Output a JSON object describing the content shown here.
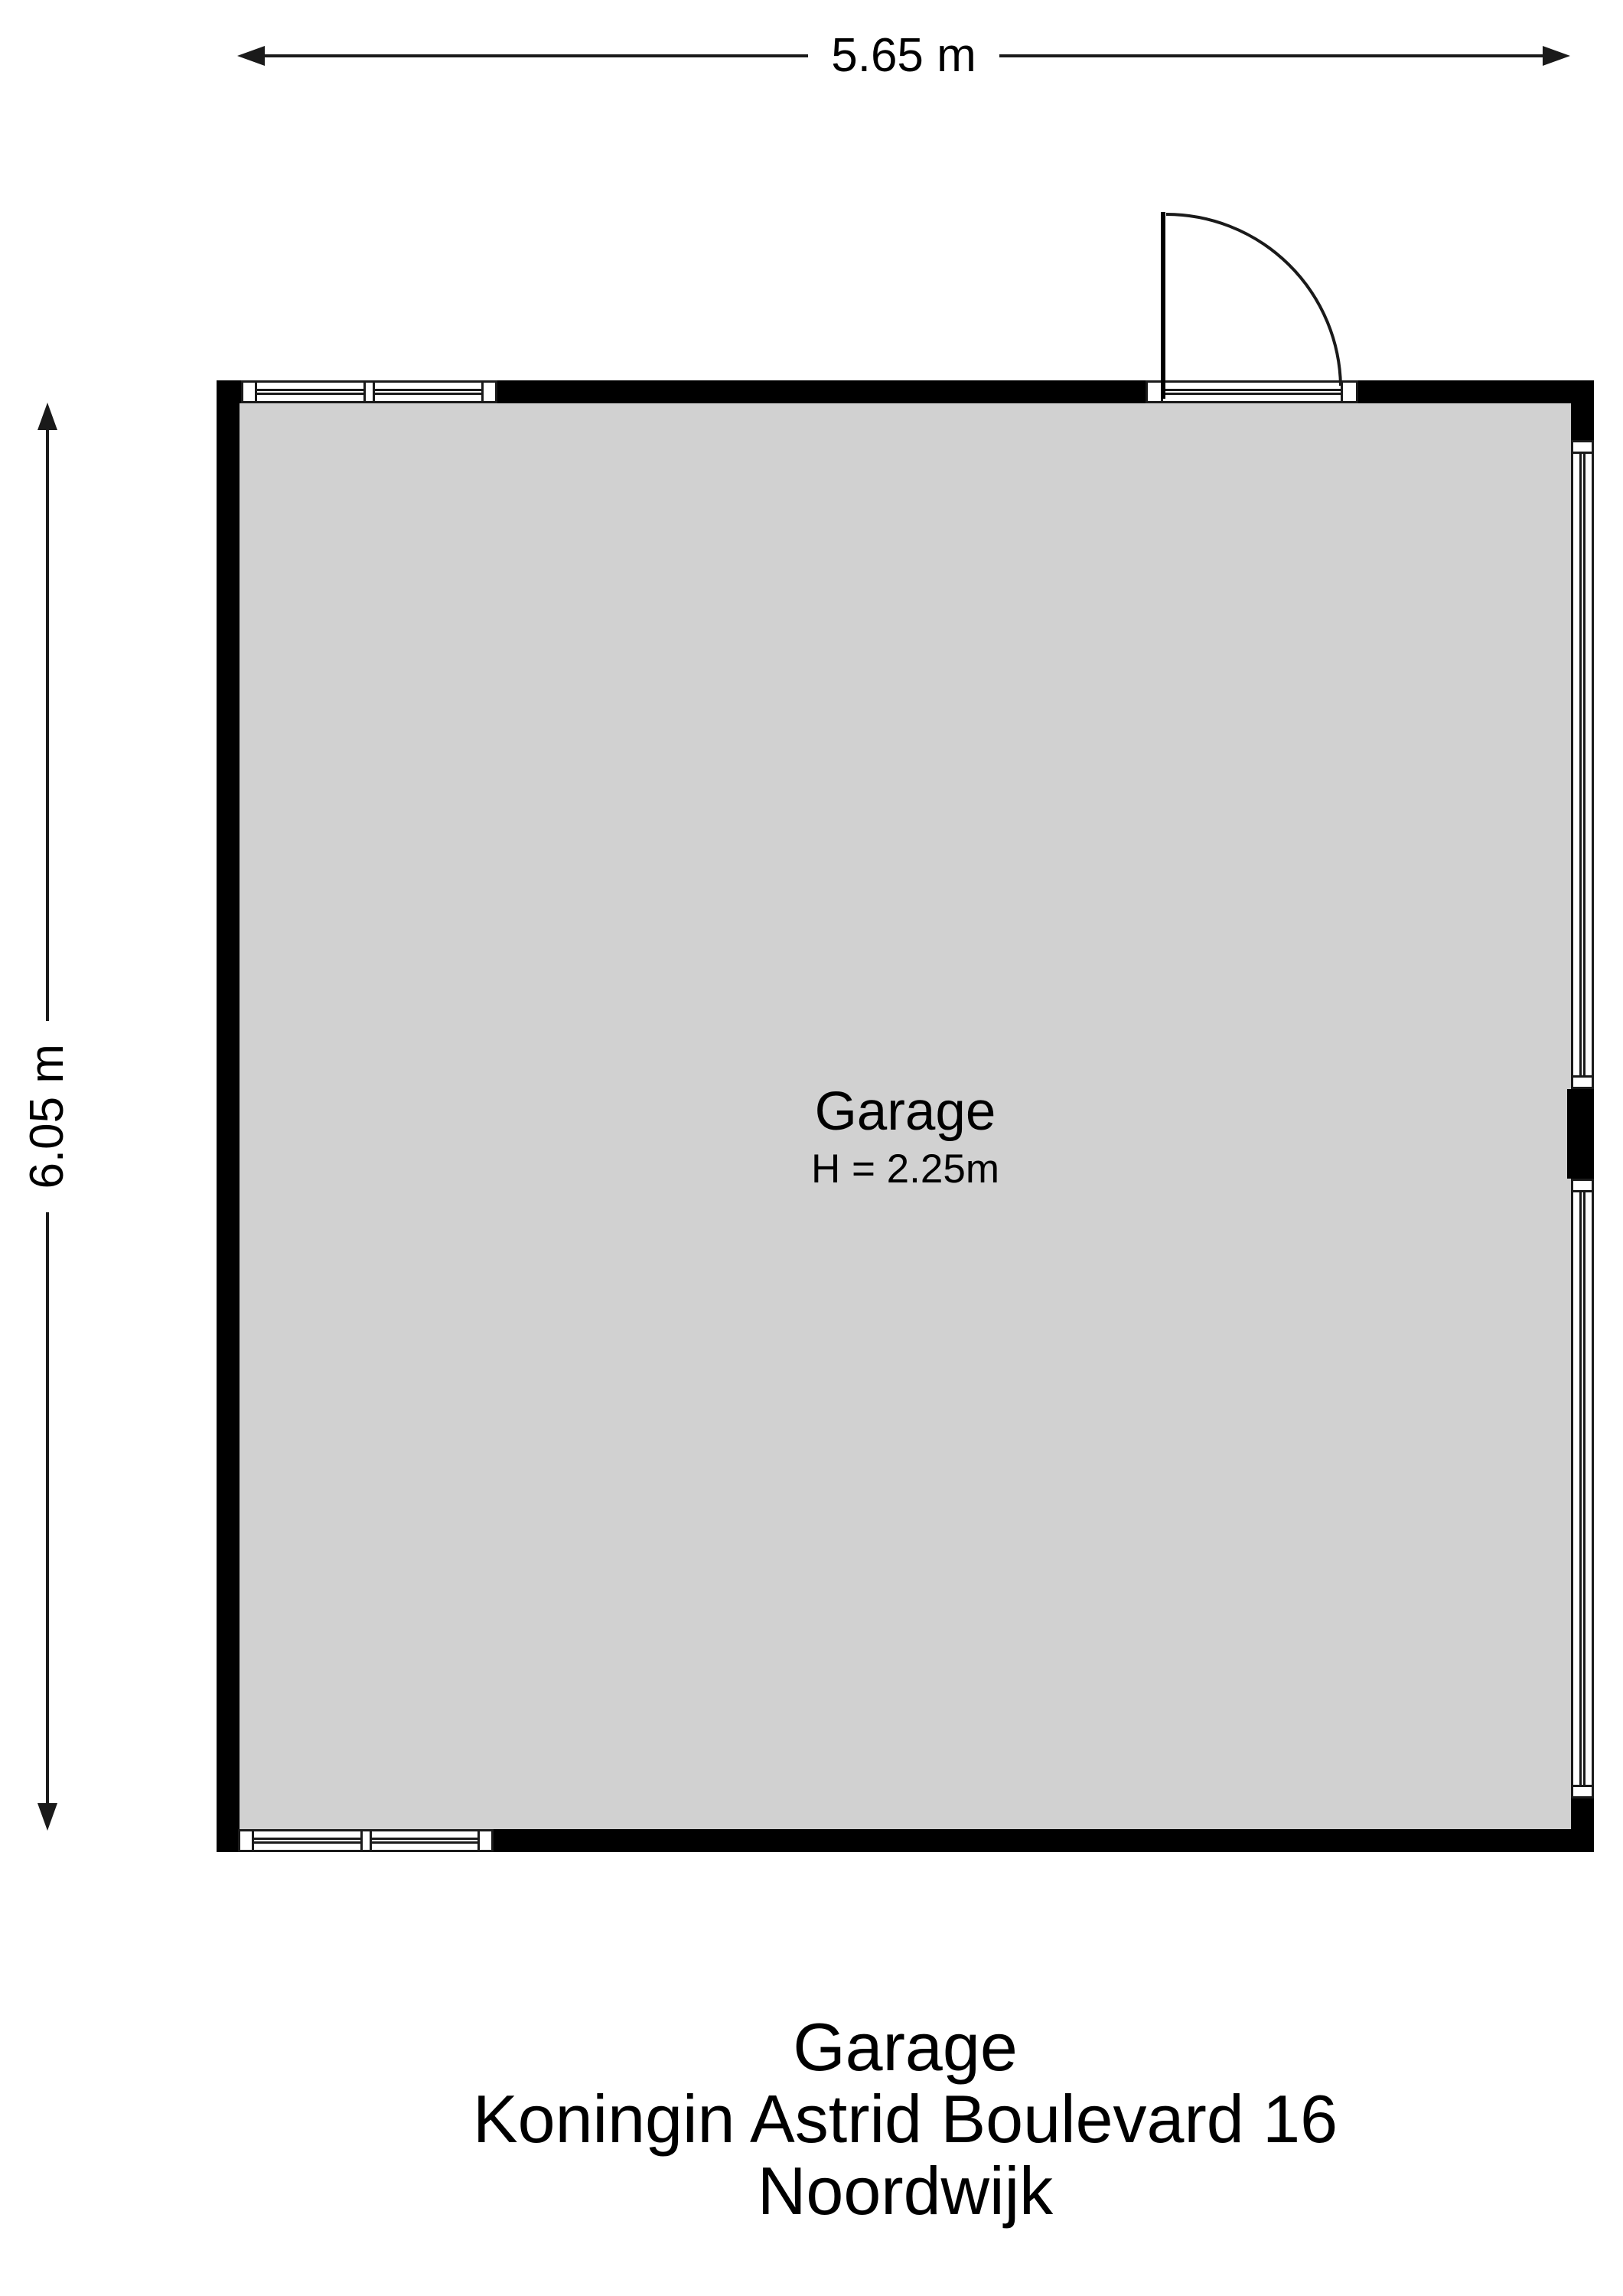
{
  "dimensions": {
    "width_label": "5.65 m",
    "height_label": "6.05 m"
  },
  "room": {
    "name": "Garage",
    "height_note": "H = 2.25m"
  },
  "title": {
    "line1": "Garage",
    "line2": "Koningin Astrid Boulevard 16",
    "line3": "Noordwijk"
  },
  "colors": {
    "wall": "#000000",
    "line": "#1a1a1a",
    "floor": "#d1d1d1",
    "background": "#ffffff"
  }
}
